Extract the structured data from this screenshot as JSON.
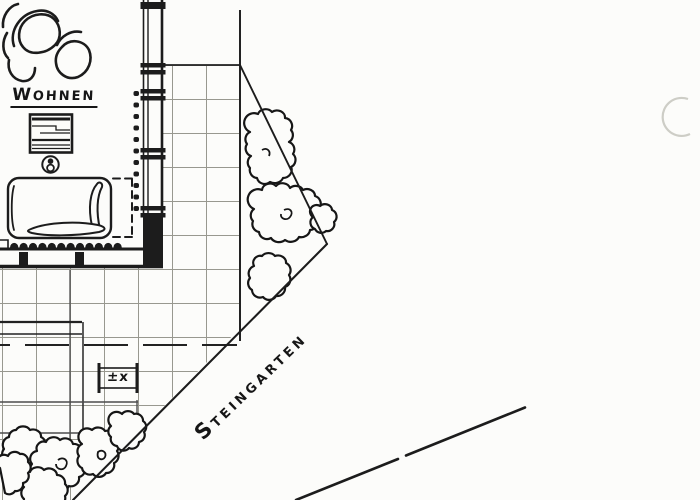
{
  "labels": {
    "room": "WOHNEN",
    "garden": "STEINGARTEN",
    "elevation_marker": "±x"
  },
  "colors": {
    "ink": "#1c1c1c",
    "grid_line": "#98988f",
    "paper": "#fcfcfa",
    "scan_artifact": "#cdcdc6"
  }
}
